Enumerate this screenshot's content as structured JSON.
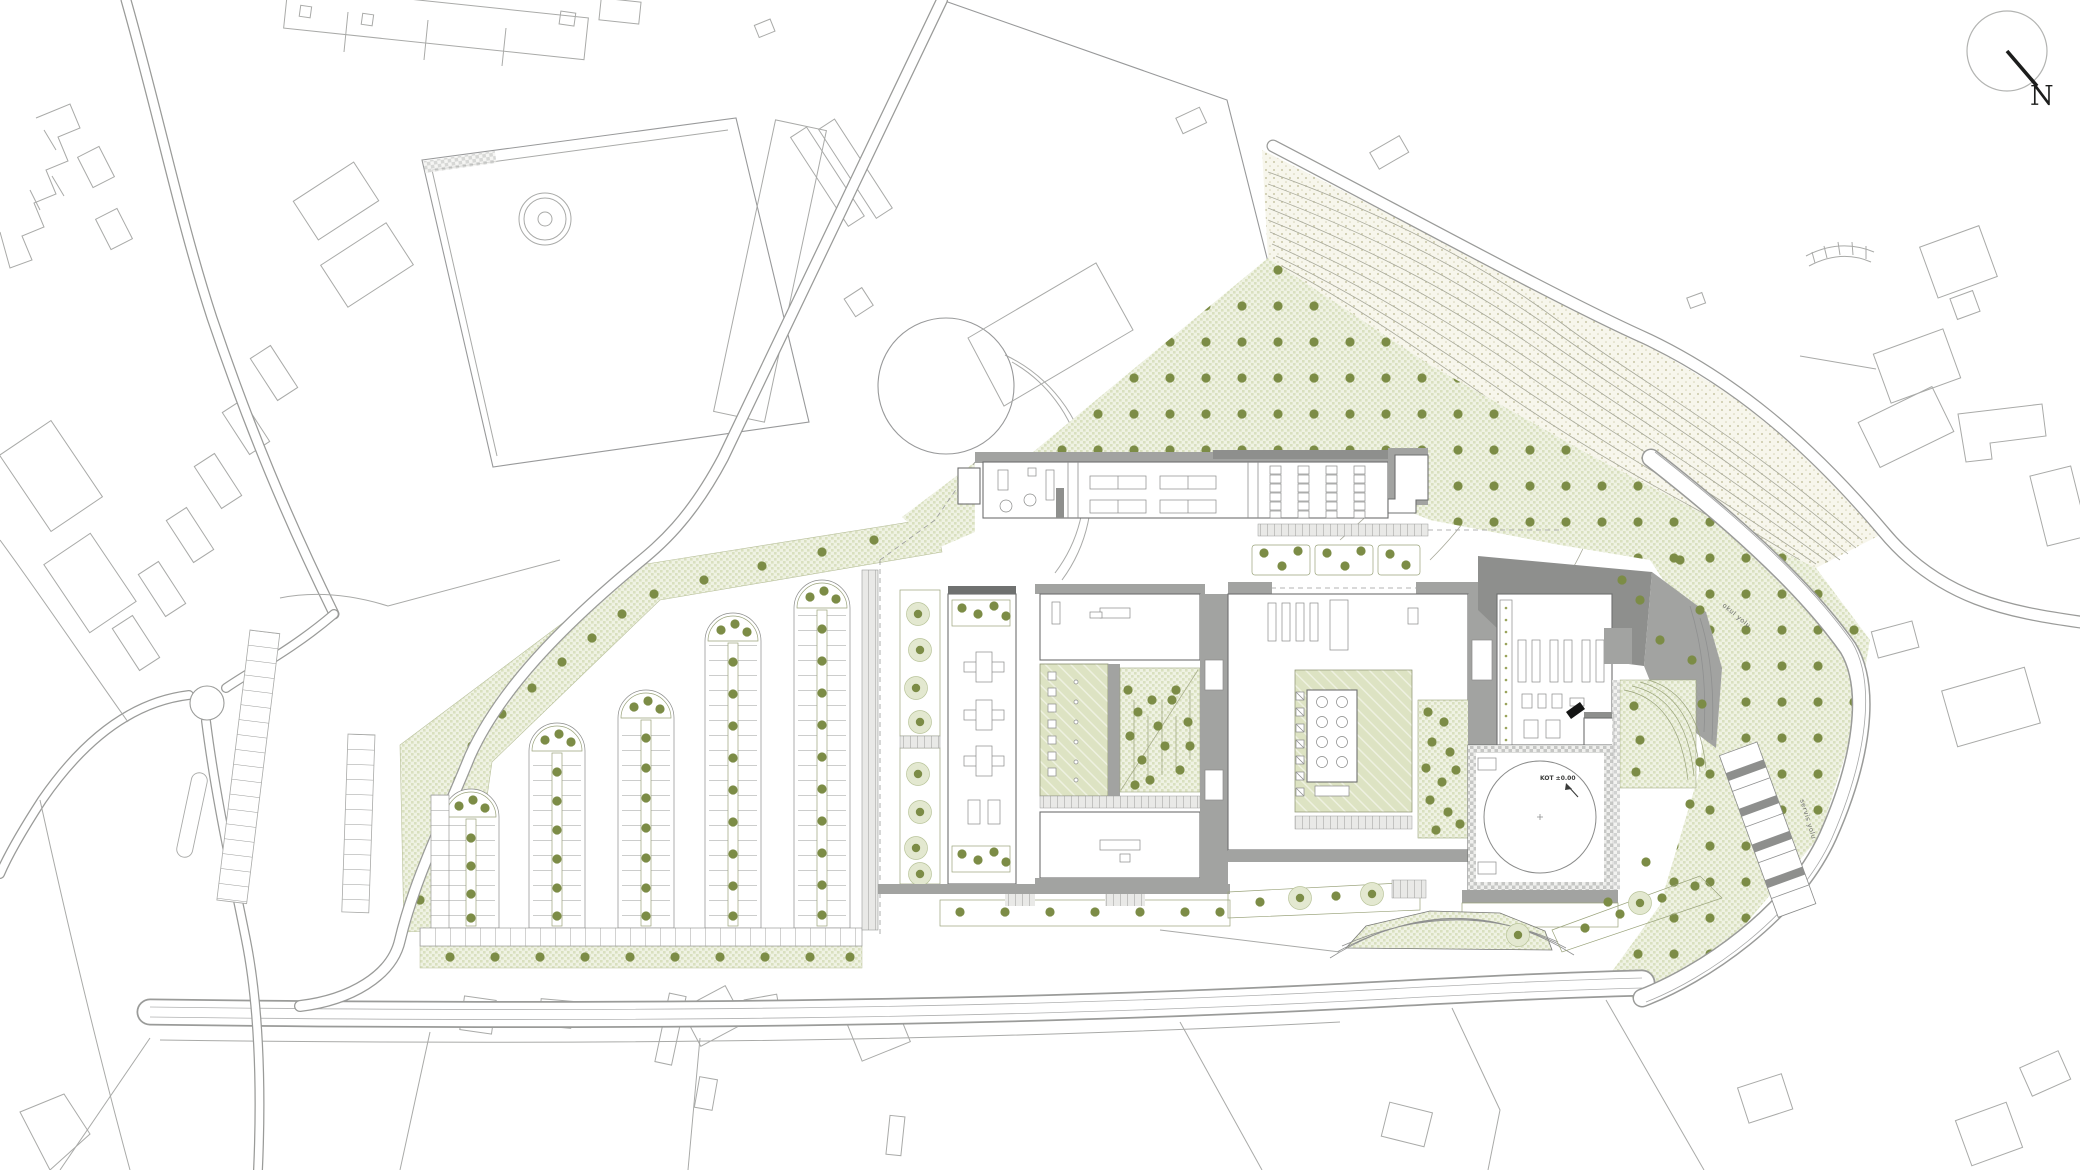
{
  "drawing": {
    "type": "architectural-site-plan",
    "description": "Campus site plan with building complex, tree-lined parking rows, planted meadow with tree grid, hillside contours and surrounding urban context"
  },
  "north_arrow": {
    "label": "N"
  },
  "annotations": {
    "hall_elevation_label": "KOT ±0.00",
    "road_label_upper": "okul yolu",
    "road_label_lower": "servis yolu"
  },
  "site": {
    "parking_rows": 5,
    "building_blocks": 4,
    "courtyards": 4,
    "sports_hall_shape": "square with inscribed circle"
  },
  "colors": {
    "paper": "#ffffff",
    "context_line": "#a9aaa8",
    "building_line": "#6f7070",
    "roof_gray": "#a2a3a1",
    "roof_dark": "#8e8f8d",
    "planting_checker": "#dbe2c3",
    "tree_dot": "#7c8c46",
    "hillside_dot": "#c4c3a6",
    "needle_black": "#1c1d1c"
  }
}
